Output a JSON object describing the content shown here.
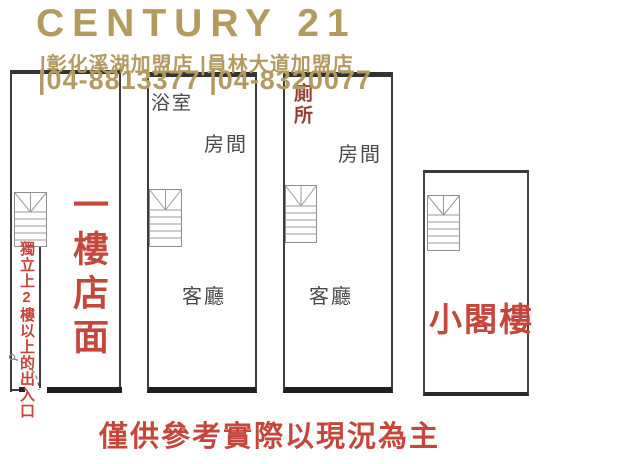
{
  "header": {
    "brand": "CENTURY 21",
    "stores": "|彰化溪湖加盟店 |員林大道加盟店",
    "phones": "|04-8813377 |04-8320077"
  },
  "floorplan": {
    "unit1": {
      "label": "一樓店面",
      "entrance_note": "獨立上2樓以上的出入口"
    },
    "unit2": {
      "bathroom": "浴室",
      "room": "房間",
      "living_room": "客廳"
    },
    "unit3": {
      "toilet": "廁所",
      "room": "房間",
      "living_room": "客廳"
    },
    "unit4": {
      "label": "小閣樓"
    }
  },
  "footer": {
    "disclaimer": "僅供參考實際以現況為主"
  },
  "icons": {
    "staircase": "staircase-icon",
    "door_swing": "door-swing-icon"
  },
  "colors": {
    "brand_gold": "#b39a5f",
    "accent_red": "#c5463a",
    "toilet_dark_red": "#963f36",
    "wall": "#3c3c3c",
    "label_gray": "#4a4a4a"
  }
}
